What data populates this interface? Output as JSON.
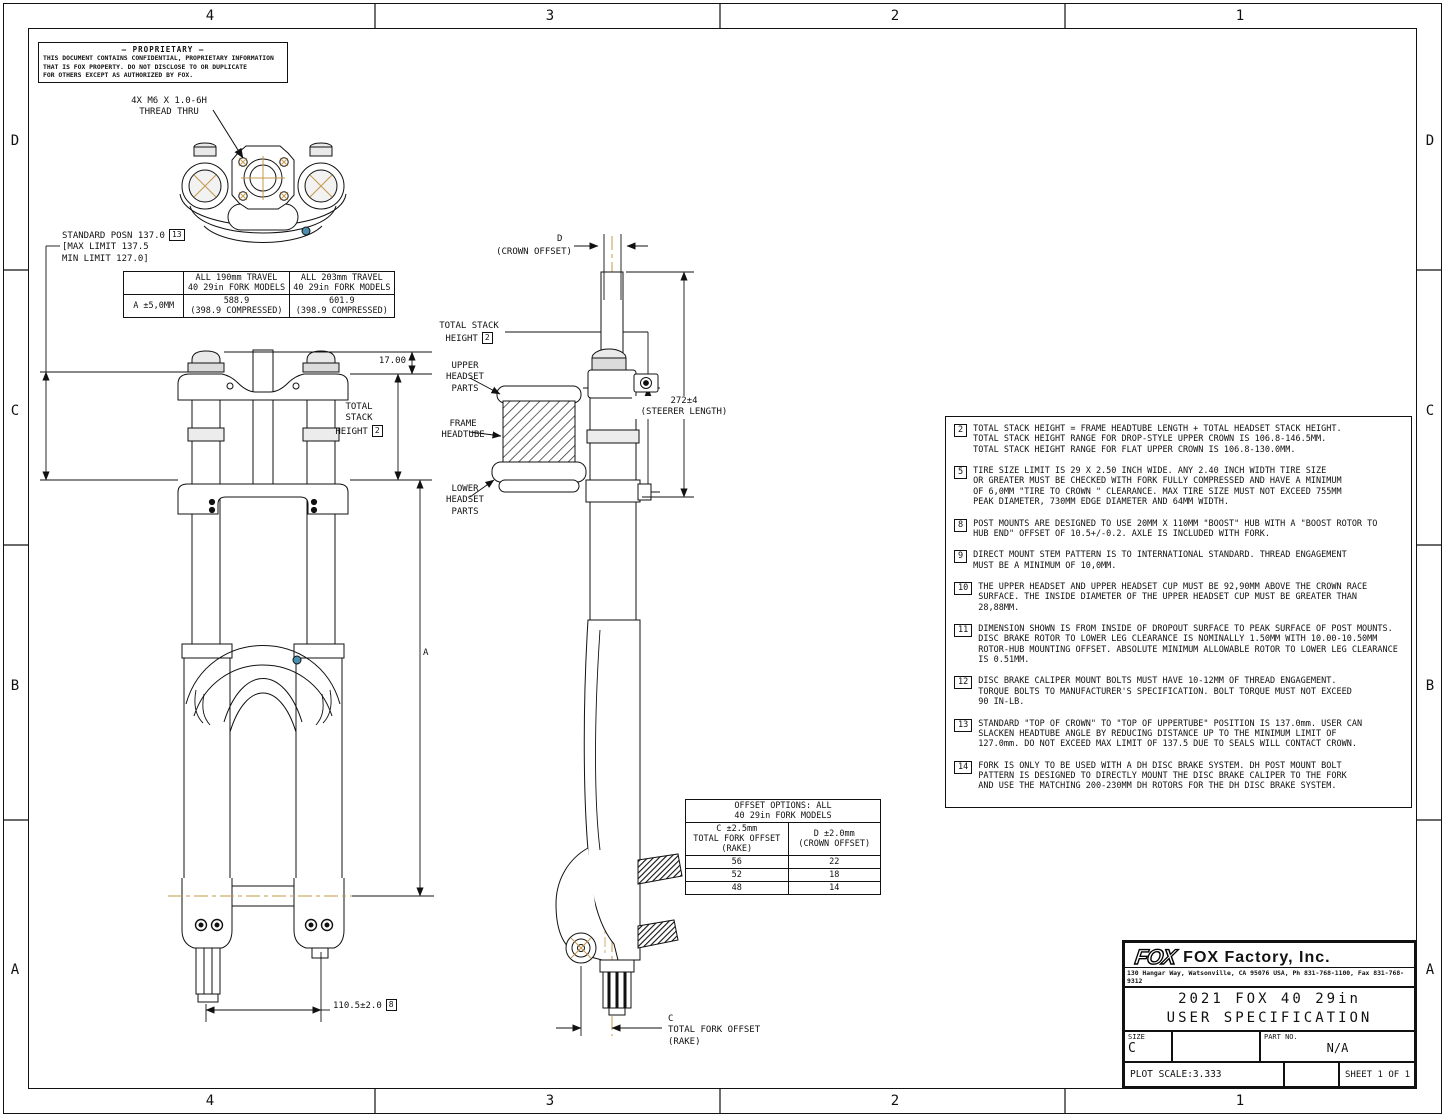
{
  "frame": {
    "zone_columns": [
      "4",
      "3",
      "2",
      "1"
    ],
    "zone_rows": [
      "D",
      "C",
      "B",
      "A"
    ]
  },
  "proprietary": {
    "title": "— PROPRIETARY —",
    "body": "THIS DOCUMENT CONTAINS CONFIDENTIAL, PROPRIETARY INFORMATION\nTHAT IS FOX PROPERTY.  DO NOT DISCLOSE TO OR DUPLICATE\nFOR OTHERS EXCEPT AS AUTHORIZED BY FOX."
  },
  "labels": {
    "thread_callout": "4X M6 X 1.0-6H\nTHREAD THRU",
    "standard_posn": "STANDARD POSN 137.0",
    "standard_posn_ref": "13",
    "standard_posn_limits": "[MAX LIMIT 137.5\nMIN LIMIT 127.0]",
    "dim_17": "17.00",
    "total_stack_lines": "TOTAL\nSTACK",
    "total_stack_height_word": "HEIGHT",
    "total_stack_ref": "2",
    "total_stack_detail_line": "TOTAL STACK",
    "upper_headset": "UPPER\nHEADSET\nPARTS",
    "frame_headtube": "FRAME\nHEADTUBE",
    "lower_headset": "LOWER\nHEADSET\nPARTS",
    "crown_offset_letter": "D",
    "crown_offset": "(CROWN OFFSET)",
    "steerer_length": "272±4\n(STEERER LENGTH)",
    "dim_a_letter": "A",
    "dim_hub": "110.5±2.0",
    "dim_hub_ref": "8",
    "fork_offset": "C\nTOTAL FORK OFFSET\n(RAKE)"
  },
  "travel_table": {
    "col1_header": "ALL 190mm TRAVEL\n40 29in FORK MODELS",
    "col2_header": "ALL 203mm TRAVEL\n40 29in FORK MODELS",
    "row_label": "A ±5,0MM",
    "col1_value": "588.9\n(398.9 COMPRESSED)",
    "col2_value": "601.9\n(398.9 COMPRESSED)"
  },
  "offset_table": {
    "title": "OFFSET OPTIONS: ALL\n40 29in FORK MODELS",
    "col1_header": "C ±2.5mm\nTOTAL FORK OFFSET\n(RAKE)",
    "col2_header": "D ±2.0mm\n(CROWN OFFSET)",
    "rows": [
      [
        "56",
        "22"
      ],
      [
        "52",
        "18"
      ],
      [
        "48",
        "14"
      ]
    ]
  },
  "notes": [
    {
      "ref": "2",
      "text": "TOTAL STACK HEIGHT = FRAME HEADTUBE LENGTH + TOTAL HEADSET STACK HEIGHT.\nTOTAL STACK HEIGHT RANGE FOR DROP-STYLE UPPER CROWN IS 106.8-146.5MM.\nTOTAL STACK HEIGHT RANGE FOR FLAT UPPER CROWN IS 106.8-130.0MM."
    },
    {
      "ref": "5",
      "text": "TIRE SIZE LIMIT IS 29 X 2.50 INCH WIDE.  ANY 2.40 INCH WIDTH TIRE SIZE\nOR GREATER MUST BE CHECKED WITH FORK FULLY COMPRESSED AND HAVE A MINIMUM\nOF 6,0MM \"TIRE TO CROWN \" CLEARANCE. MAX TIRE SIZE MUST NOT EXCEED 755MM\nPEAK DIAMETER, 730MM EDGE DIAMETER AND 64MM WIDTH."
    },
    {
      "ref": "8",
      "text": "POST MOUNTS ARE DESIGNED TO USE 20MM X 110MM \"BOOST\" HUB WITH A \"BOOST ROTOR TO\nHUB END\" OFFSET OF 10.5+/-0.2.  AXLE IS INCLUDED WITH FORK."
    },
    {
      "ref": "9",
      "text": "DIRECT MOUNT STEM PATTERN IS TO INTERNATIONAL STANDARD. THREAD ENGAGEMENT\nMUST BE A MINIMUM OF 10,0MM."
    },
    {
      "ref": "10",
      "text": "THE UPPER HEADSET AND UPPER HEADSET CUP MUST BE 92,90MM ABOVE THE CROWN RACE\nSURFACE. THE INSIDE DIAMETER OF THE UPPER HEADSET CUP MUST BE GREATER THAN\n28,88MM."
    },
    {
      "ref": "11",
      "text": "DIMENSION SHOWN IS FROM INSIDE OF DROPOUT SURFACE TO PEAK SURFACE OF POST MOUNTS.\nDISC BRAKE ROTOR TO LOWER LEG CLEARANCE IS NOMINALLY 1.50MM WITH 10.00-10.50MM\nROTOR-HUB MOUNTING OFFSET. ABSOLUTE MINIMUM ALLOWABLE ROTOR TO LOWER LEG CLEARANCE\nIS 0.51MM."
    },
    {
      "ref": "12",
      "text": "DISC BRAKE CALIPER MOUNT BOLTS MUST HAVE 10-12MM OF THREAD ENGAGEMENT.\nTORQUE BOLTS TO MANUFACTURER'S SPECIFICATION. BOLT TORQUE MUST NOT EXCEED\n90 IN-LB."
    },
    {
      "ref": "13",
      "text": "STANDARD \"TOP OF CROWN\" TO \"TOP OF UPPERTUBE\" POSITION IS 137.0mm. USER CAN\nSLACKEN HEADTUBE ANGLE BY REDUCING DISTANCE UP TO THE MINIMUM LIMIT OF\n127.0mm. DO NOT EXCEED MAX LIMIT OF 137.5 DUE TO SEALS WILL CONTACT CROWN."
    },
    {
      "ref": "14",
      "text": "FORK IS ONLY TO BE USED WITH A DH DISC BRAKE SYSTEM. DH POST MOUNT BOLT\nPATTERN IS DESIGNED TO DIRECTLY MOUNT THE DISC BRAKE CALIPER TO THE FORK\nAND USE THE MATCHING 200-230MM DH ROTORS FOR THE DH DISC BRAKE SYSTEM."
    }
  ],
  "title_block": {
    "logo": "FOX",
    "company": "FOX Factory, Inc.",
    "address": "130 Hangar Way, Watsonville, CA 95076 USA, Ph 831-768-1100, Fax 831-768-9312",
    "drawing_title": "2021 FOX 40 29in\nUSER SPECIFICATION",
    "size_label": "SIZE",
    "size_value": "C",
    "part_label": "PART NO.",
    "part_value": "N/A",
    "plot_scale": "PLOT SCALE:3.333",
    "sheet": "SHEET 1 OF 1"
  },
  "colors": {
    "line": "#111111",
    "centerline": "#c49a4a",
    "accent_blue": "#4a8fae"
  }
}
